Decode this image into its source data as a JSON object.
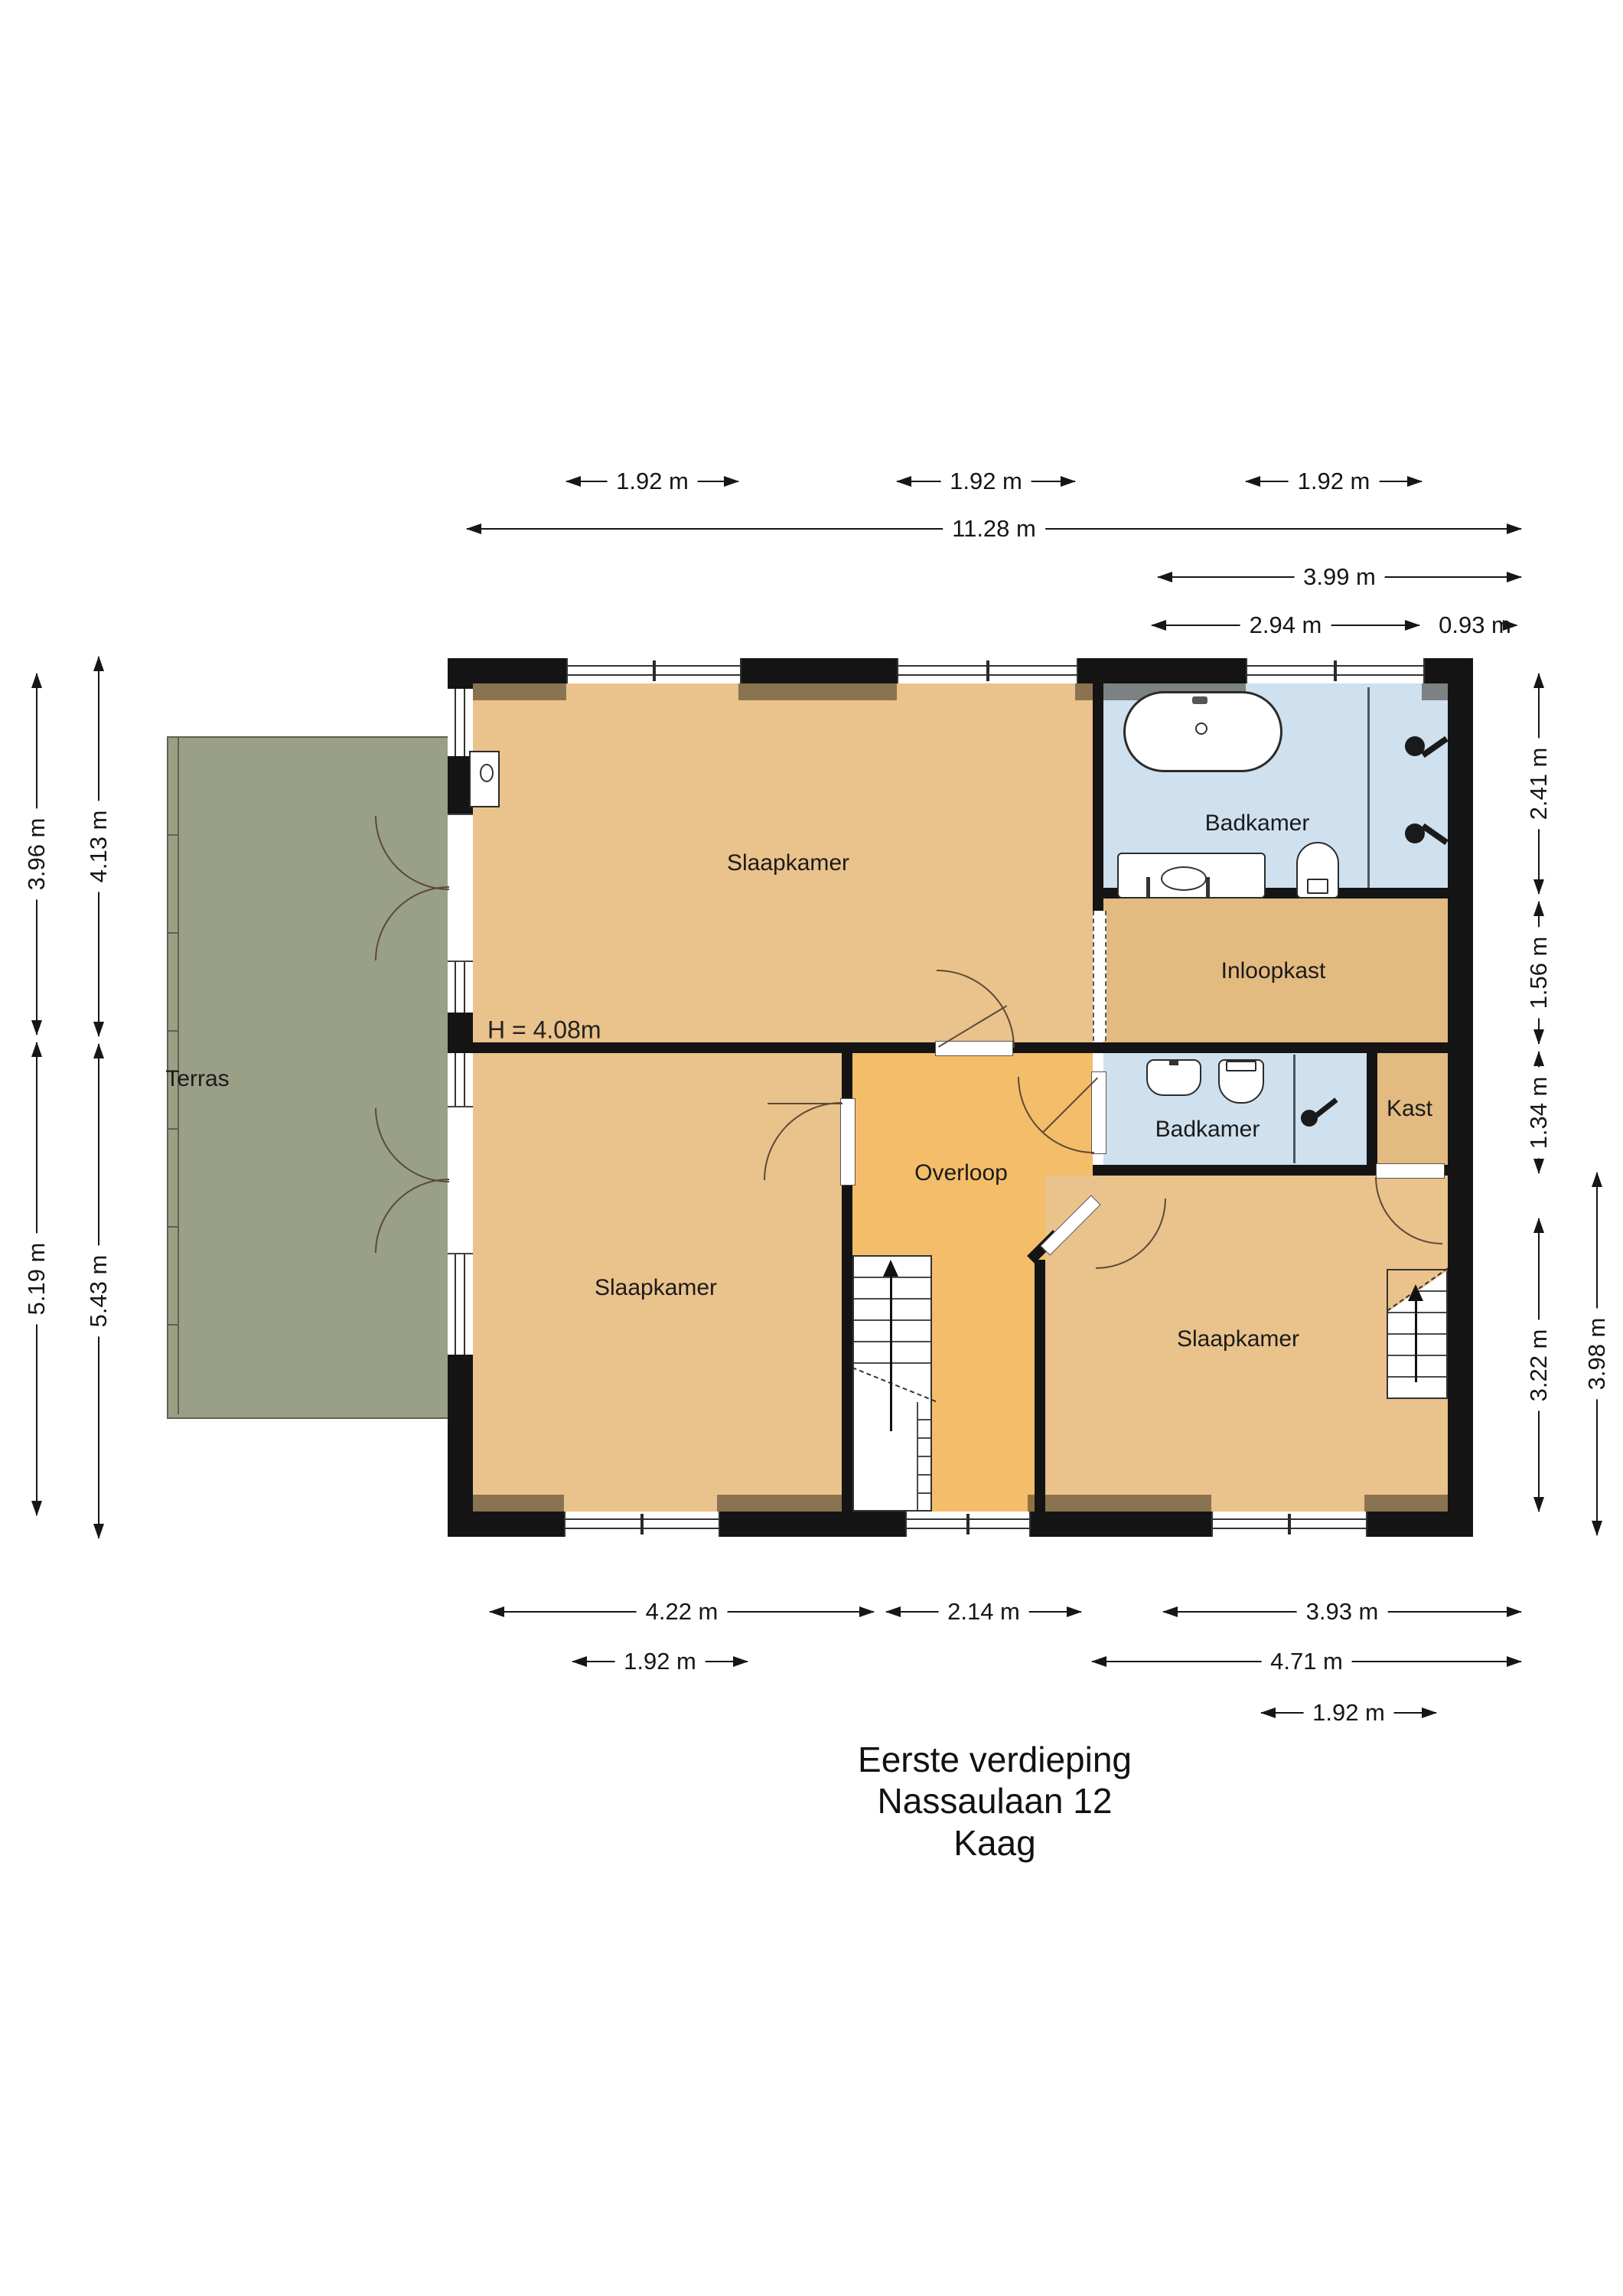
{
  "title": {
    "line1": "Eerste verdieping",
    "line2": "Nassaulaan 12",
    "line3": "Kaag"
  },
  "rooms": {
    "terras": "Terras",
    "slaapkamer_top": "Slaapkamer",
    "badkamer_top": "Badkamer",
    "inloopkast": "Inloopkast",
    "badkamer_small": "Badkamer",
    "kast": "Kast",
    "overloop": "Overloop",
    "slaapkamer_bottom_left": "Slaapkamer",
    "slaapkamer_bottom_right": "Slaapkamer",
    "height_note": "H = 4.08m"
  },
  "dims": {
    "top": [
      "1.92 m",
      "1.92 m",
      "1.92 m",
      "11.28 m",
      "3.99 m",
      "2.94 m",
      "0.93 m"
    ],
    "bottom": [
      "4.22 m",
      "2.14 m",
      "3.93 m",
      "1.92 m",
      "4.71 m",
      "1.92 m"
    ],
    "left": [
      "3.96 m",
      "4.13 m",
      "5.19 m",
      "5.43 m"
    ],
    "right": [
      "2.41 m",
      "1.56 m",
      "1.34 m",
      "3.22 m",
      "3.98 m"
    ]
  }
}
